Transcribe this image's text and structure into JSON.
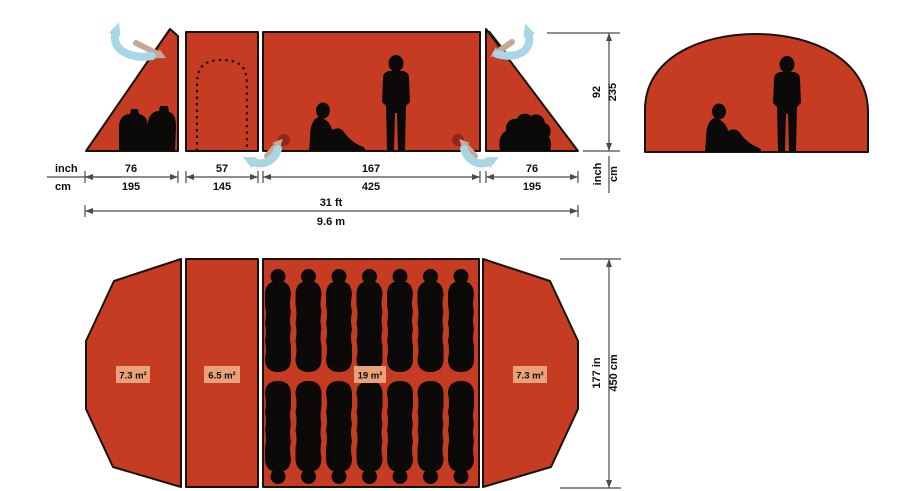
{
  "colors": {
    "tent_red": "#c63c22",
    "outline": "#18120e",
    "silhouette_black": "#0c0a09",
    "vent_maroon": "#8a2718",
    "airflow_blue": "#a9d6e5",
    "airflow_tan": "#c3a996",
    "dimension_gray": "#4a4a4a",
    "badge_salmon": "#e9a17a",
    "background": "#ffffff"
  },
  "side_view": {
    "units": {
      "inch": "inch",
      "cm": "cm"
    },
    "segments": [
      {
        "inch": "76",
        "cm": "195"
      },
      {
        "inch": "57",
        "cm": "145"
      },
      {
        "inch": "167",
        "cm": "425"
      },
      {
        "inch": "76",
        "cm": "195"
      }
    ],
    "total": {
      "ft": "31 ft",
      "m": "9.6 m"
    },
    "height": {
      "inch": "92",
      "cm": "235"
    }
  },
  "floor_plan": {
    "areas": [
      "7.3 m²",
      "6.5 m²",
      "19 m²",
      "7.3 m²"
    ],
    "width": {
      "inch": "177 in",
      "cm": "450 cm"
    },
    "sleeping_bag_count": 14
  }
}
